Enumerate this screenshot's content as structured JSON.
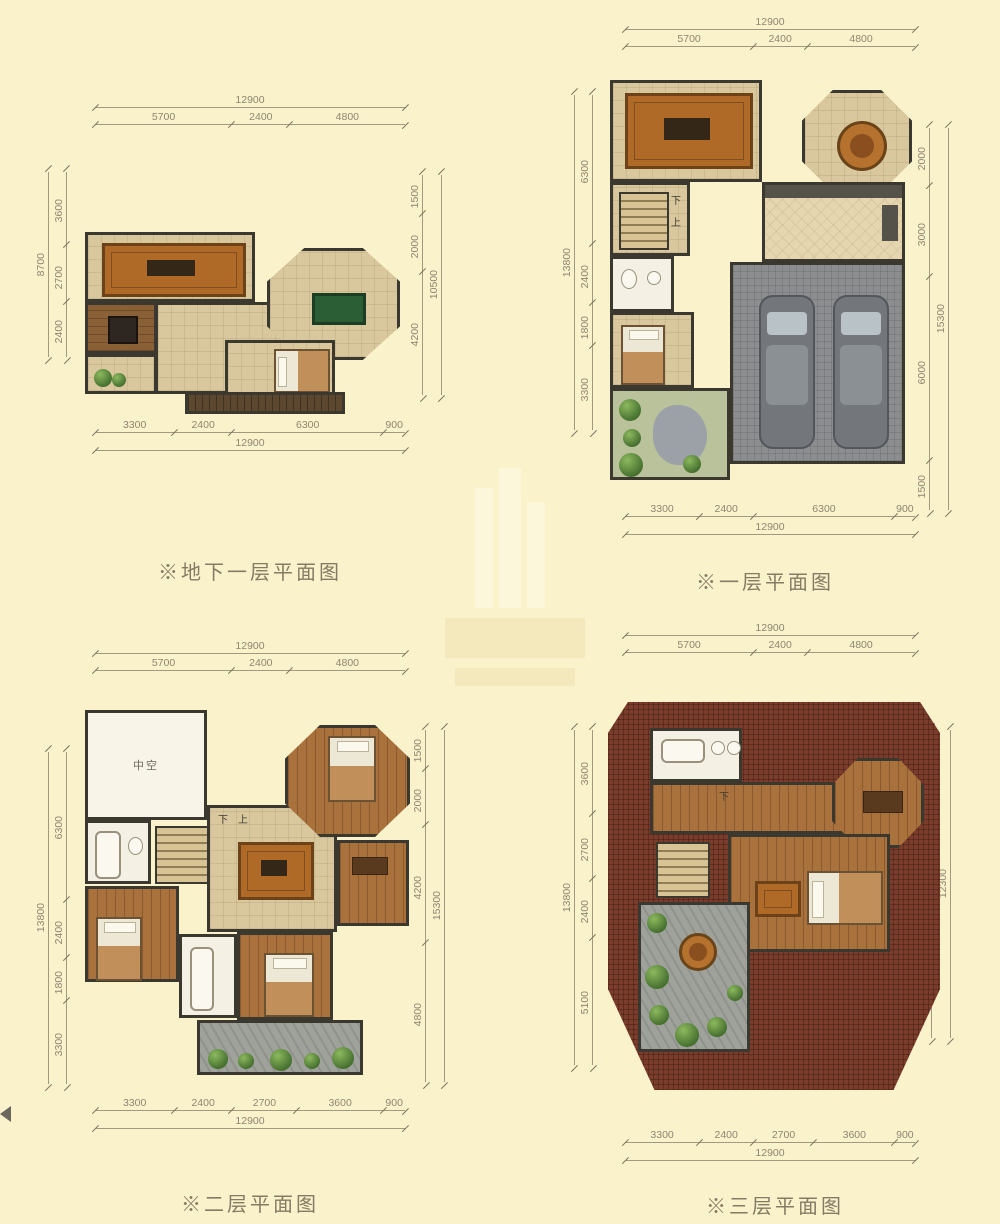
{
  "palette": {
    "paper": "#FAF2CB",
    "wall": "#3A382F",
    "tile": "#D9C89E",
    "wood": "#A9713C",
    "deck": "#5C482F",
    "garage": "#8B8D8F",
    "stone": "#9EA29B",
    "roof": "#7A3C2B",
    "rug": "#B06A28",
    "dimline": "#A29A7E",
    "dimtick": "#7D7560",
    "dimtext": "#8D8671",
    "caption": "#857A64"
  },
  "plans": [
    {
      "key": "basement",
      "caption": "※地下一层平面图",
      "dims": {
        "top": {
          "overall": "12900",
          "segments": [
            "5700",
            "2400",
            "4800"
          ]
        },
        "bottom": {
          "segments": [
            "3300",
            "2400",
            "6300",
            "900"
          ],
          "overall": "12900"
        },
        "left": {
          "overall": "8700",
          "segments": [
            "3600",
            "2700",
            "2400"
          ]
        },
        "right": {
          "segments": [
            "1500",
            "2000",
            "4200"
          ],
          "overall": "10500"
        }
      },
      "room_labels": []
    },
    {
      "key": "floor1",
      "caption": "※一层平面图",
      "dims": {
        "top": {
          "overall": "12900",
          "segments": [
            "5700",
            "2400",
            "4800"
          ]
        },
        "bottom": {
          "segments": [
            "3300",
            "2400",
            "6300",
            "900"
          ],
          "overall": "12900"
        },
        "left": {
          "overall": "13800",
          "segments": [
            "6300",
            "2400",
            "1800",
            "3300"
          ]
        },
        "right": {
          "segments": [
            "2000",
            "3000",
            "6000",
            "1500"
          ],
          "overall": "15300"
        }
      },
      "room_labels": [
        "下",
        "上"
      ]
    },
    {
      "key": "floor2",
      "caption": "※二层平面图",
      "dims": {
        "top": {
          "overall": "12900",
          "segments": [
            "5700",
            "2400",
            "4800"
          ]
        },
        "bottom": {
          "segments": [
            "3300",
            "2400",
            "2700",
            "3600",
            "900"
          ],
          "overall": "12900"
        },
        "left": {
          "overall": "13800",
          "segments": [
            "6300",
            "2400",
            "1800",
            "3300"
          ]
        },
        "right": {
          "segments": [
            "1500",
            "2000",
            "4200",
            "4800"
          ],
          "overall": "15300"
        }
      },
      "room_labels": [
        "中空",
        "下",
        "上"
      ]
    },
    {
      "key": "floor3",
      "caption": "※三层平面图",
      "dims": {
        "top": {
          "overall": "12900",
          "segments": [
            "5700",
            "2400",
            "4800"
          ]
        },
        "bottom": {
          "segments": [
            "3300",
            "2400",
            "2700",
            "3600",
            "900"
          ],
          "overall": "12900"
        },
        "left": {
          "overall": "13800",
          "segments": [
            "3600",
            "2700",
            "2400",
            "5100"
          ]
        },
        "right": {
          "segments": [
            "1500",
            "2000",
            "6000"
          ],
          "overall": "12300"
        }
      },
      "room_labels": [
        "下"
      ]
    }
  ]
}
